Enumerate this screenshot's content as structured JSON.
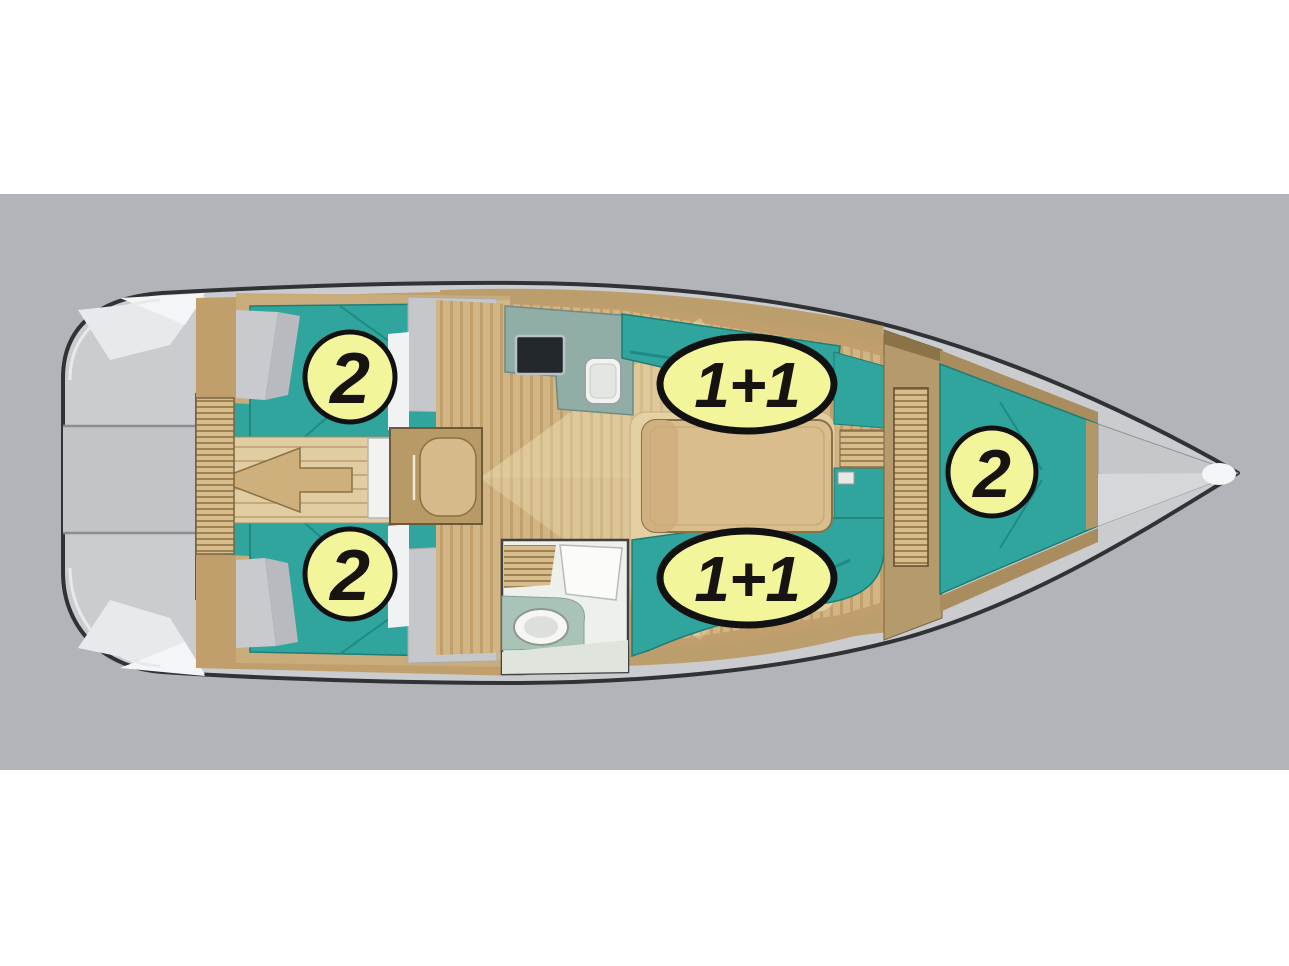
{
  "diagram": {
    "kind": "sailboat-deck-plan",
    "berth_badges": [
      {
        "area": "aft-cabin-port",
        "label": "2",
        "shape": "circle"
      },
      {
        "area": "salon-settee-port",
        "label": "1+1",
        "shape": "ellipse"
      },
      {
        "area": "aft-cabin-starboard",
        "label": "2",
        "shape": "circle"
      },
      {
        "area": "salon-settee-starboard",
        "label": "1+1",
        "shape": "ellipse"
      },
      {
        "area": "v-berth-bow",
        "label": "2",
        "shape": "circle"
      }
    ],
    "colors": {
      "page_background": "#ffffff",
      "canvas_gray": "#b2b4ba",
      "hull_outline": "#303234",
      "deck_gray": "#cbccd0",
      "deck_highlight": "#f2f3f5",
      "upholstery_teal": "#2fa59d",
      "upholstery_teal_dark": "#1d7d77",
      "wood_light": "#d8c094",
      "wood_mid": "#c09f6c",
      "wood_dark": "#8a7144",
      "galley_counter": "#90aea6",
      "stove_black": "#23282c",
      "head_white": "#eef0ec",
      "badge_fill": "#f3f59b",
      "badge_outline": "#111111",
      "badge_text": "#171310"
    }
  }
}
